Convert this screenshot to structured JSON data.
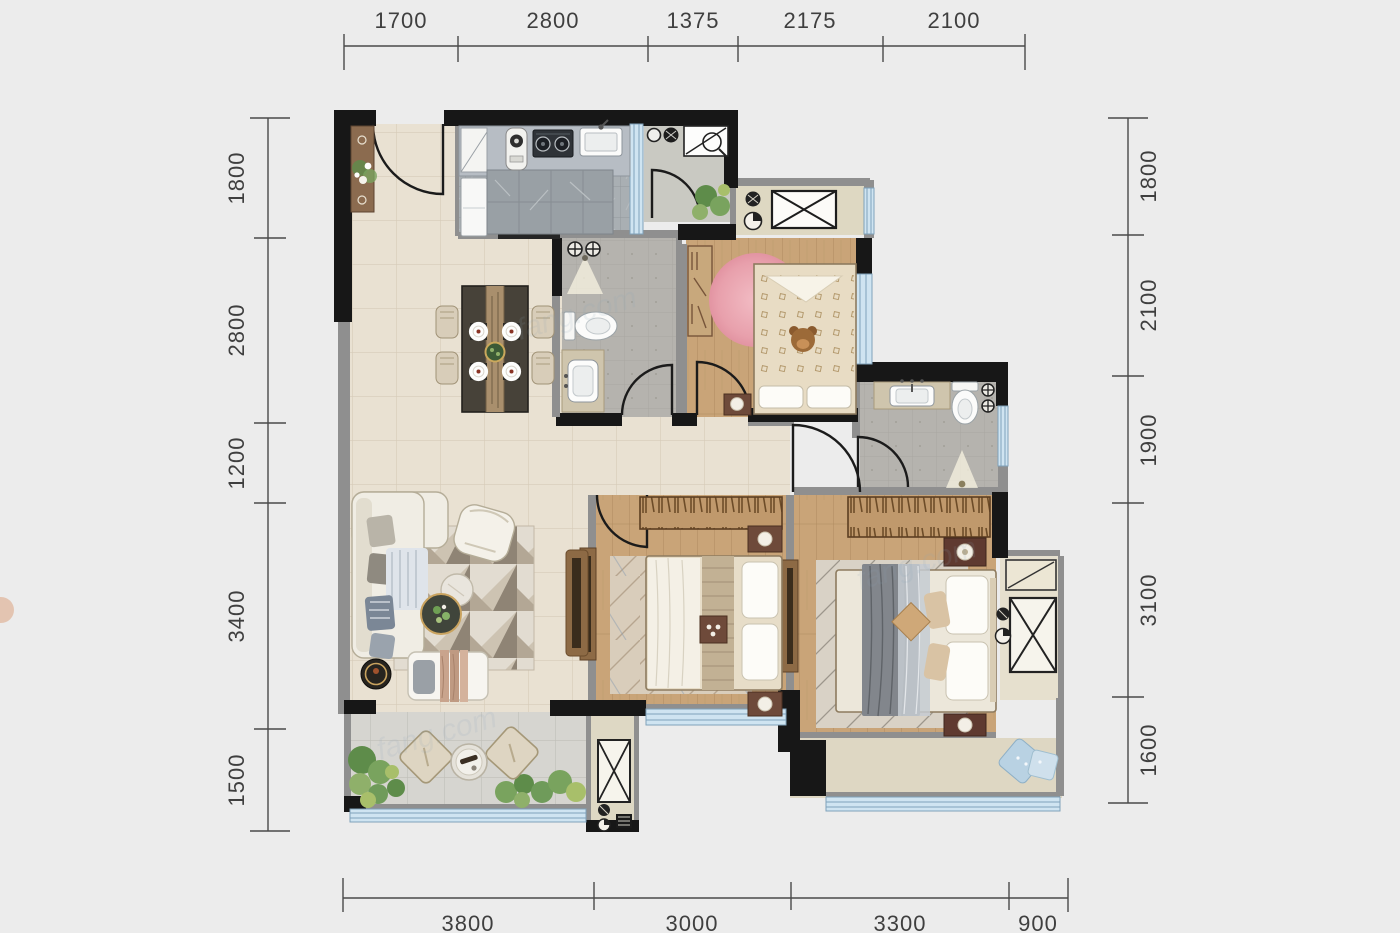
{
  "dims": {
    "top": [
      "1700",
      "2800",
      "1375",
      "2175",
      "2100"
    ],
    "left": [
      "1800",
      "2800",
      "1200",
      "3400",
      "1500"
    ],
    "right": [
      "1800",
      "2100",
      "1900",
      "3100",
      "1600"
    ],
    "bottom": [
      "3800",
      "3000",
      "3300",
      "900"
    ]
  },
  "watermark": "fang.com",
  "colors": {
    "background": "#ececec",
    "wall_black": "#171717",
    "wall_gray": "#8f8f8f",
    "floor_tile": "#e9e1d2",
    "floor_wood": "#c9a478",
    "floor_bath": "#b5b3ae",
    "floor_kitchen": "#a9afb3",
    "floor_balcony": "#d6d5d0",
    "floor_utility": "#ded8c2",
    "window_glass": "#cfe4f1",
    "greenery": "#6f9b5a",
    "rug_pink": "#eba9b1",
    "furniture_dark_wood": "#6e4a3a",
    "dim_text": "#3f3f3f"
  }
}
